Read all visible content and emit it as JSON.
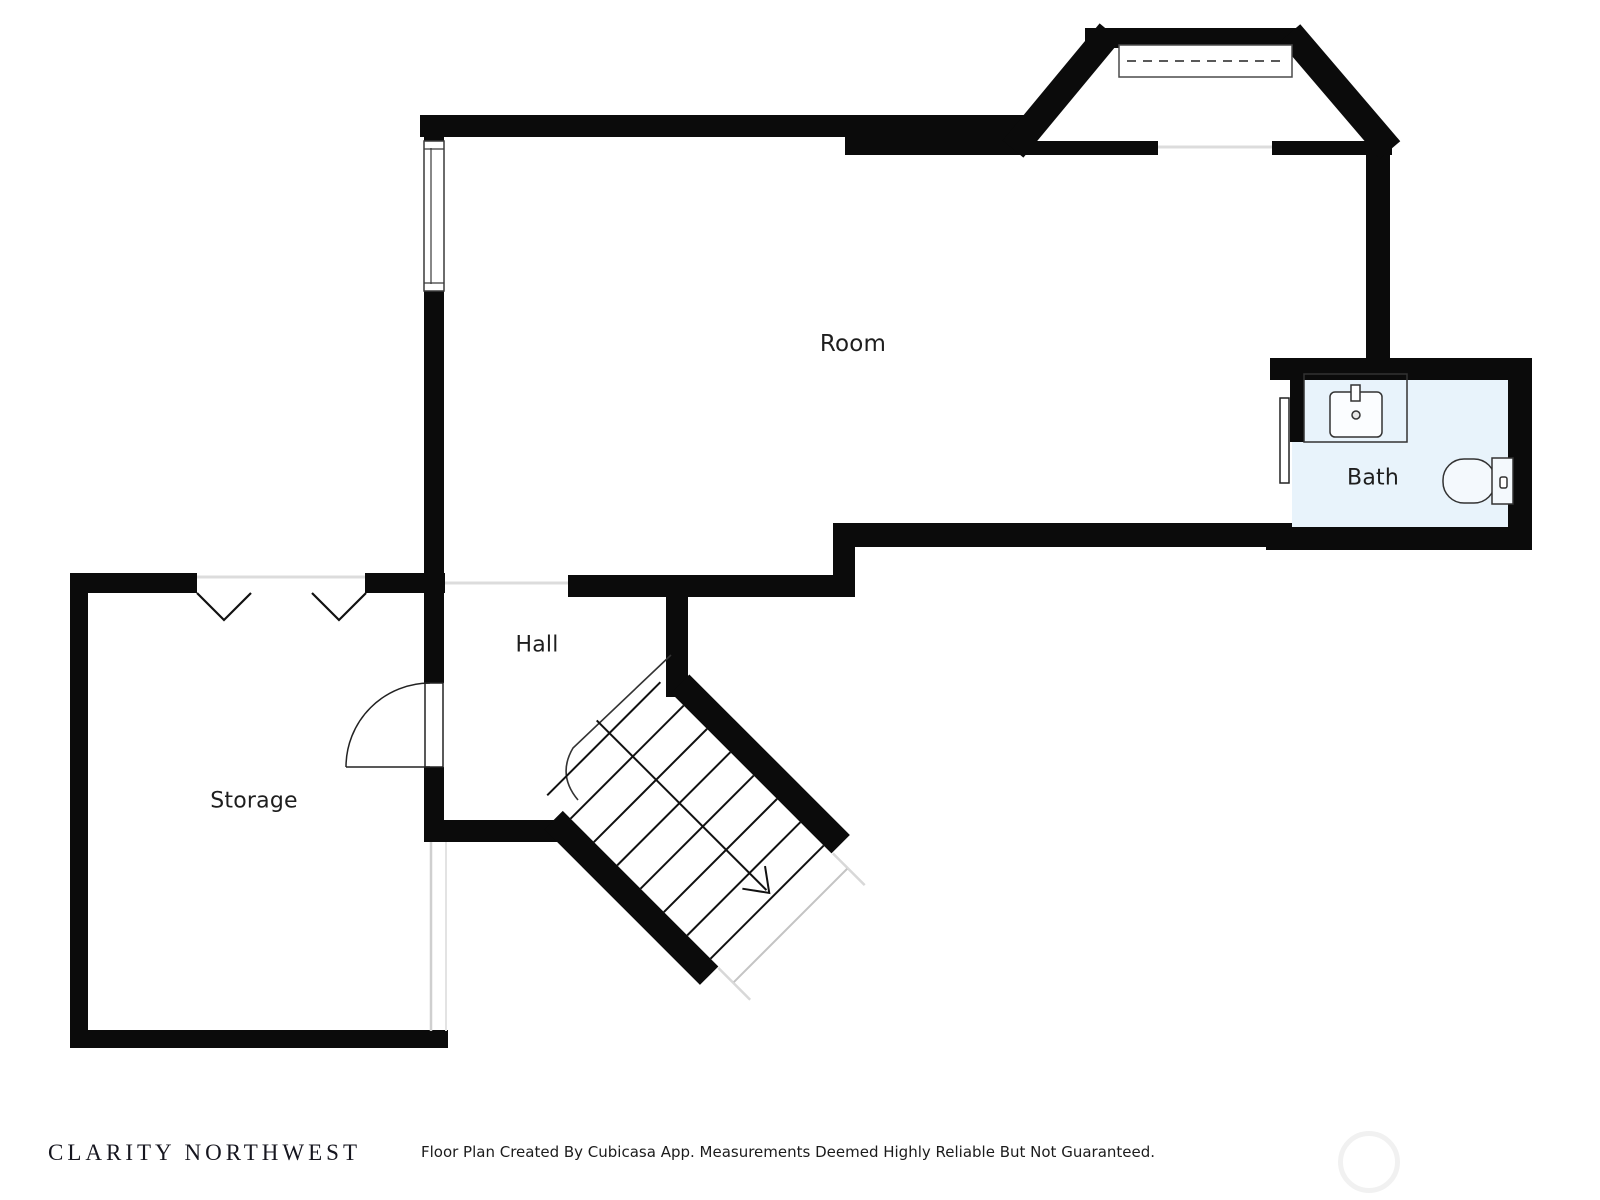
{
  "plan": {
    "labels": {
      "room": "Room",
      "bath": "Bath",
      "hall": "Hall",
      "storage": "Storage"
    },
    "colors": {
      "wall": "#0b0b0b",
      "bath_floor": "#e8f3fb",
      "fixture_stroke": "#333333",
      "opening_line": "#dcdcdc"
    }
  },
  "footer": {
    "brand": "CLARITY NORTHWEST",
    "disclaimer": "Floor Plan Created By Cubicasa App. Measurements Deemed Highly Reliable But Not Guaranteed."
  }
}
